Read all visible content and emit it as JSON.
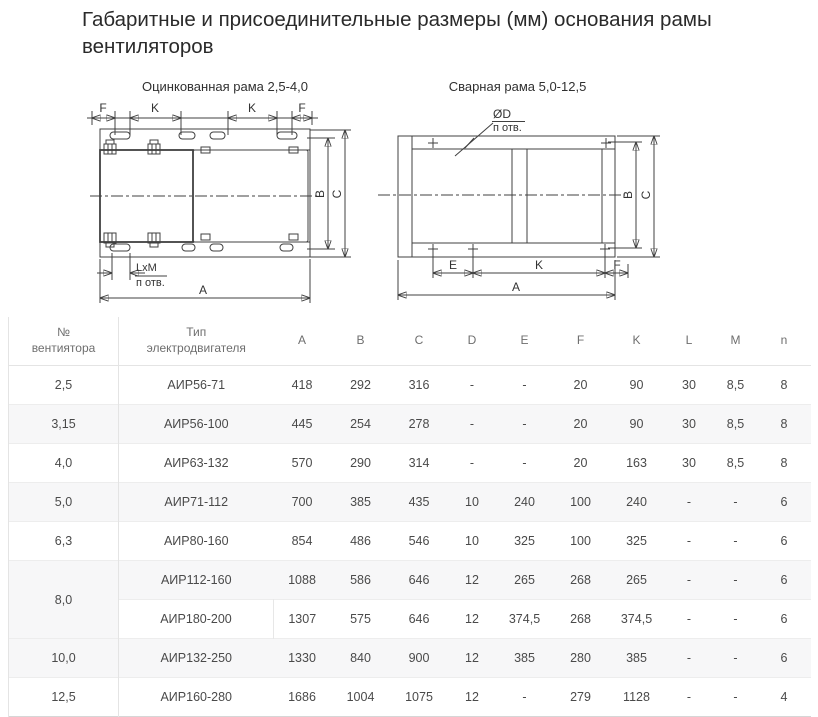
{
  "page": {
    "title": "Габаритные и присоединительные размеры (мм) основания рамы\nвентиляторов"
  },
  "diagrams": {
    "left": {
      "title": "Оцинкованная рама 2,5-4,0",
      "dims": {
        "f1": "F",
        "k1": "K",
        "k2": "K",
        "f2": "F",
        "b": "B",
        "c": "C",
        "lxm": "LxM",
        "n_otv": "п отв.",
        "a": "A"
      }
    },
    "right": {
      "title": "Сварная рама 5,0-12,5",
      "dims": {
        "d": "ØD",
        "n_otv": "п отв.",
        "b": "B",
        "c": "C",
        "e": "E",
        "k": "K",
        "f": "F",
        "a": "A"
      }
    }
  },
  "table": {
    "headers": [
      "№\nвентиятора",
      "Тип\nэлектродвигателя",
      "A",
      "B",
      "C",
      "D",
      "E",
      "F",
      "K",
      "L",
      "M",
      "n"
    ],
    "rows": [
      {
        "num": "2,5",
        "type": "АИР56-71",
        "values": [
          "418",
          "292",
          "316",
          "-",
          "-",
          "20",
          "90",
          "30",
          "8,5",
          "8"
        ]
      },
      {
        "num": "3,15",
        "type": "АИР56-100",
        "values": [
          "445",
          "254",
          "278",
          "-",
          "-",
          "20",
          "90",
          "30",
          "8,5",
          "8"
        ]
      },
      {
        "num": "4,0",
        "type": "АИР63-132",
        "values": [
          "570",
          "290",
          "314",
          "-",
          "-",
          "20",
          "163",
          "30",
          "8,5",
          "8"
        ]
      },
      {
        "num": "5,0",
        "type": "АИР71-112",
        "values": [
          "700",
          "385",
          "435",
          "10",
          "240",
          "100",
          "240",
          "-",
          "-",
          "6"
        ]
      },
      {
        "num": "6,3",
        "type": "АИР80-160",
        "values": [
          "854",
          "486",
          "546",
          "10",
          "325",
          "100",
          "325",
          "-",
          "-",
          "6"
        ]
      },
      {
        "num": "8,0",
        "type": "АИР112-160",
        "values": [
          "1088",
          "586",
          "646",
          "12",
          "265",
          "268",
          "265",
          "-",
          "-",
          "6"
        ]
      },
      {
        "type": "АИР180-200",
        "values": [
          "1307",
          "575",
          "646",
          "12",
          "374,5",
          "268",
          "374,5",
          "-",
          "-",
          "6"
        ]
      },
      {
        "num": "10,0",
        "type": "АИР132-250",
        "values": [
          "1330",
          "840",
          "900",
          "12",
          "385",
          "280",
          "385",
          "-",
          "-",
          "6"
        ]
      },
      {
        "num": "12,5",
        "type": "АИР160-280",
        "values": [
          "1686",
          "1004",
          "1075",
          "12",
          "-",
          "279",
          "1128",
          "-",
          "-",
          "4"
        ]
      }
    ]
  }
}
